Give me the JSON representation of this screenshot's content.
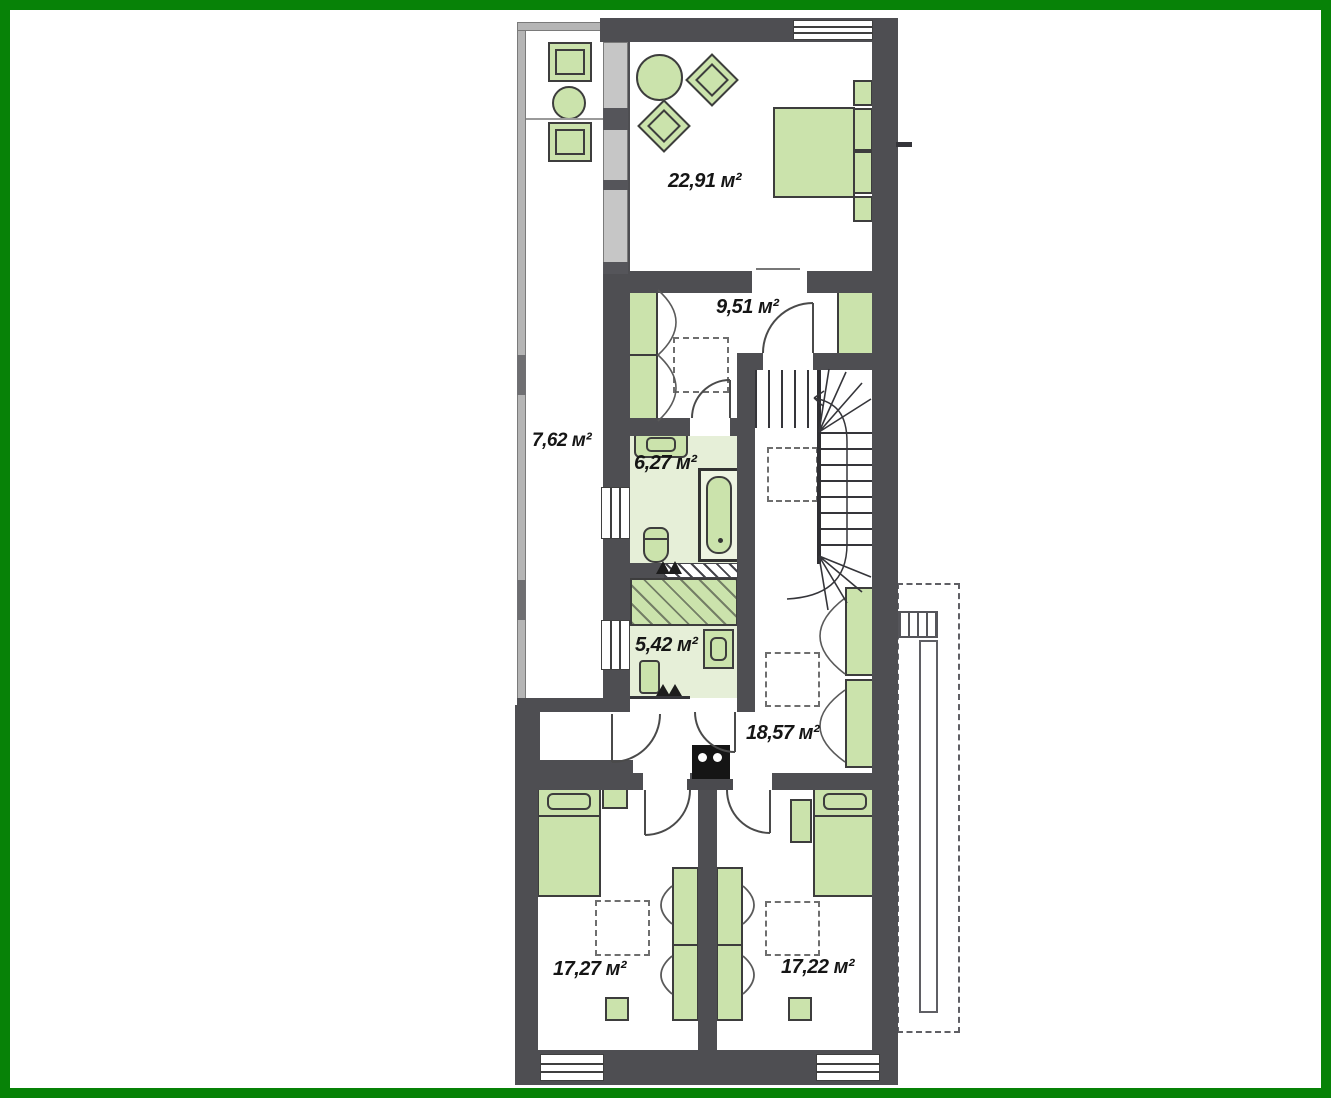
{
  "colors": {
    "frame_green": "#078207",
    "wall_gray": "#4e4e52",
    "furniture_green": "#cbe3ac",
    "furniture_outline": "#3d3d3d",
    "floor_green": "#e6efd8",
    "dash_gray": "#6e6e6e",
    "balcony_wall": "#b5b5b5"
  },
  "plan": {
    "type": "floor-plan",
    "rooms": [
      {
        "name": "bedroom-top",
        "area_label": "22,91 м²"
      },
      {
        "name": "dressing-room",
        "area_label": "9,51 м²"
      },
      {
        "name": "loggia",
        "area_label": "7,62 м²"
      },
      {
        "name": "bathroom",
        "area_label": "6,27 м²"
      },
      {
        "name": "laundry",
        "area_label": "5,42 м²"
      },
      {
        "name": "hall",
        "area_label": "18,57 м²"
      },
      {
        "name": "bedroom-left",
        "area_label": "17,27 м²"
      },
      {
        "name": "bedroom-right",
        "area_label": "17,22 м²"
      }
    ]
  }
}
